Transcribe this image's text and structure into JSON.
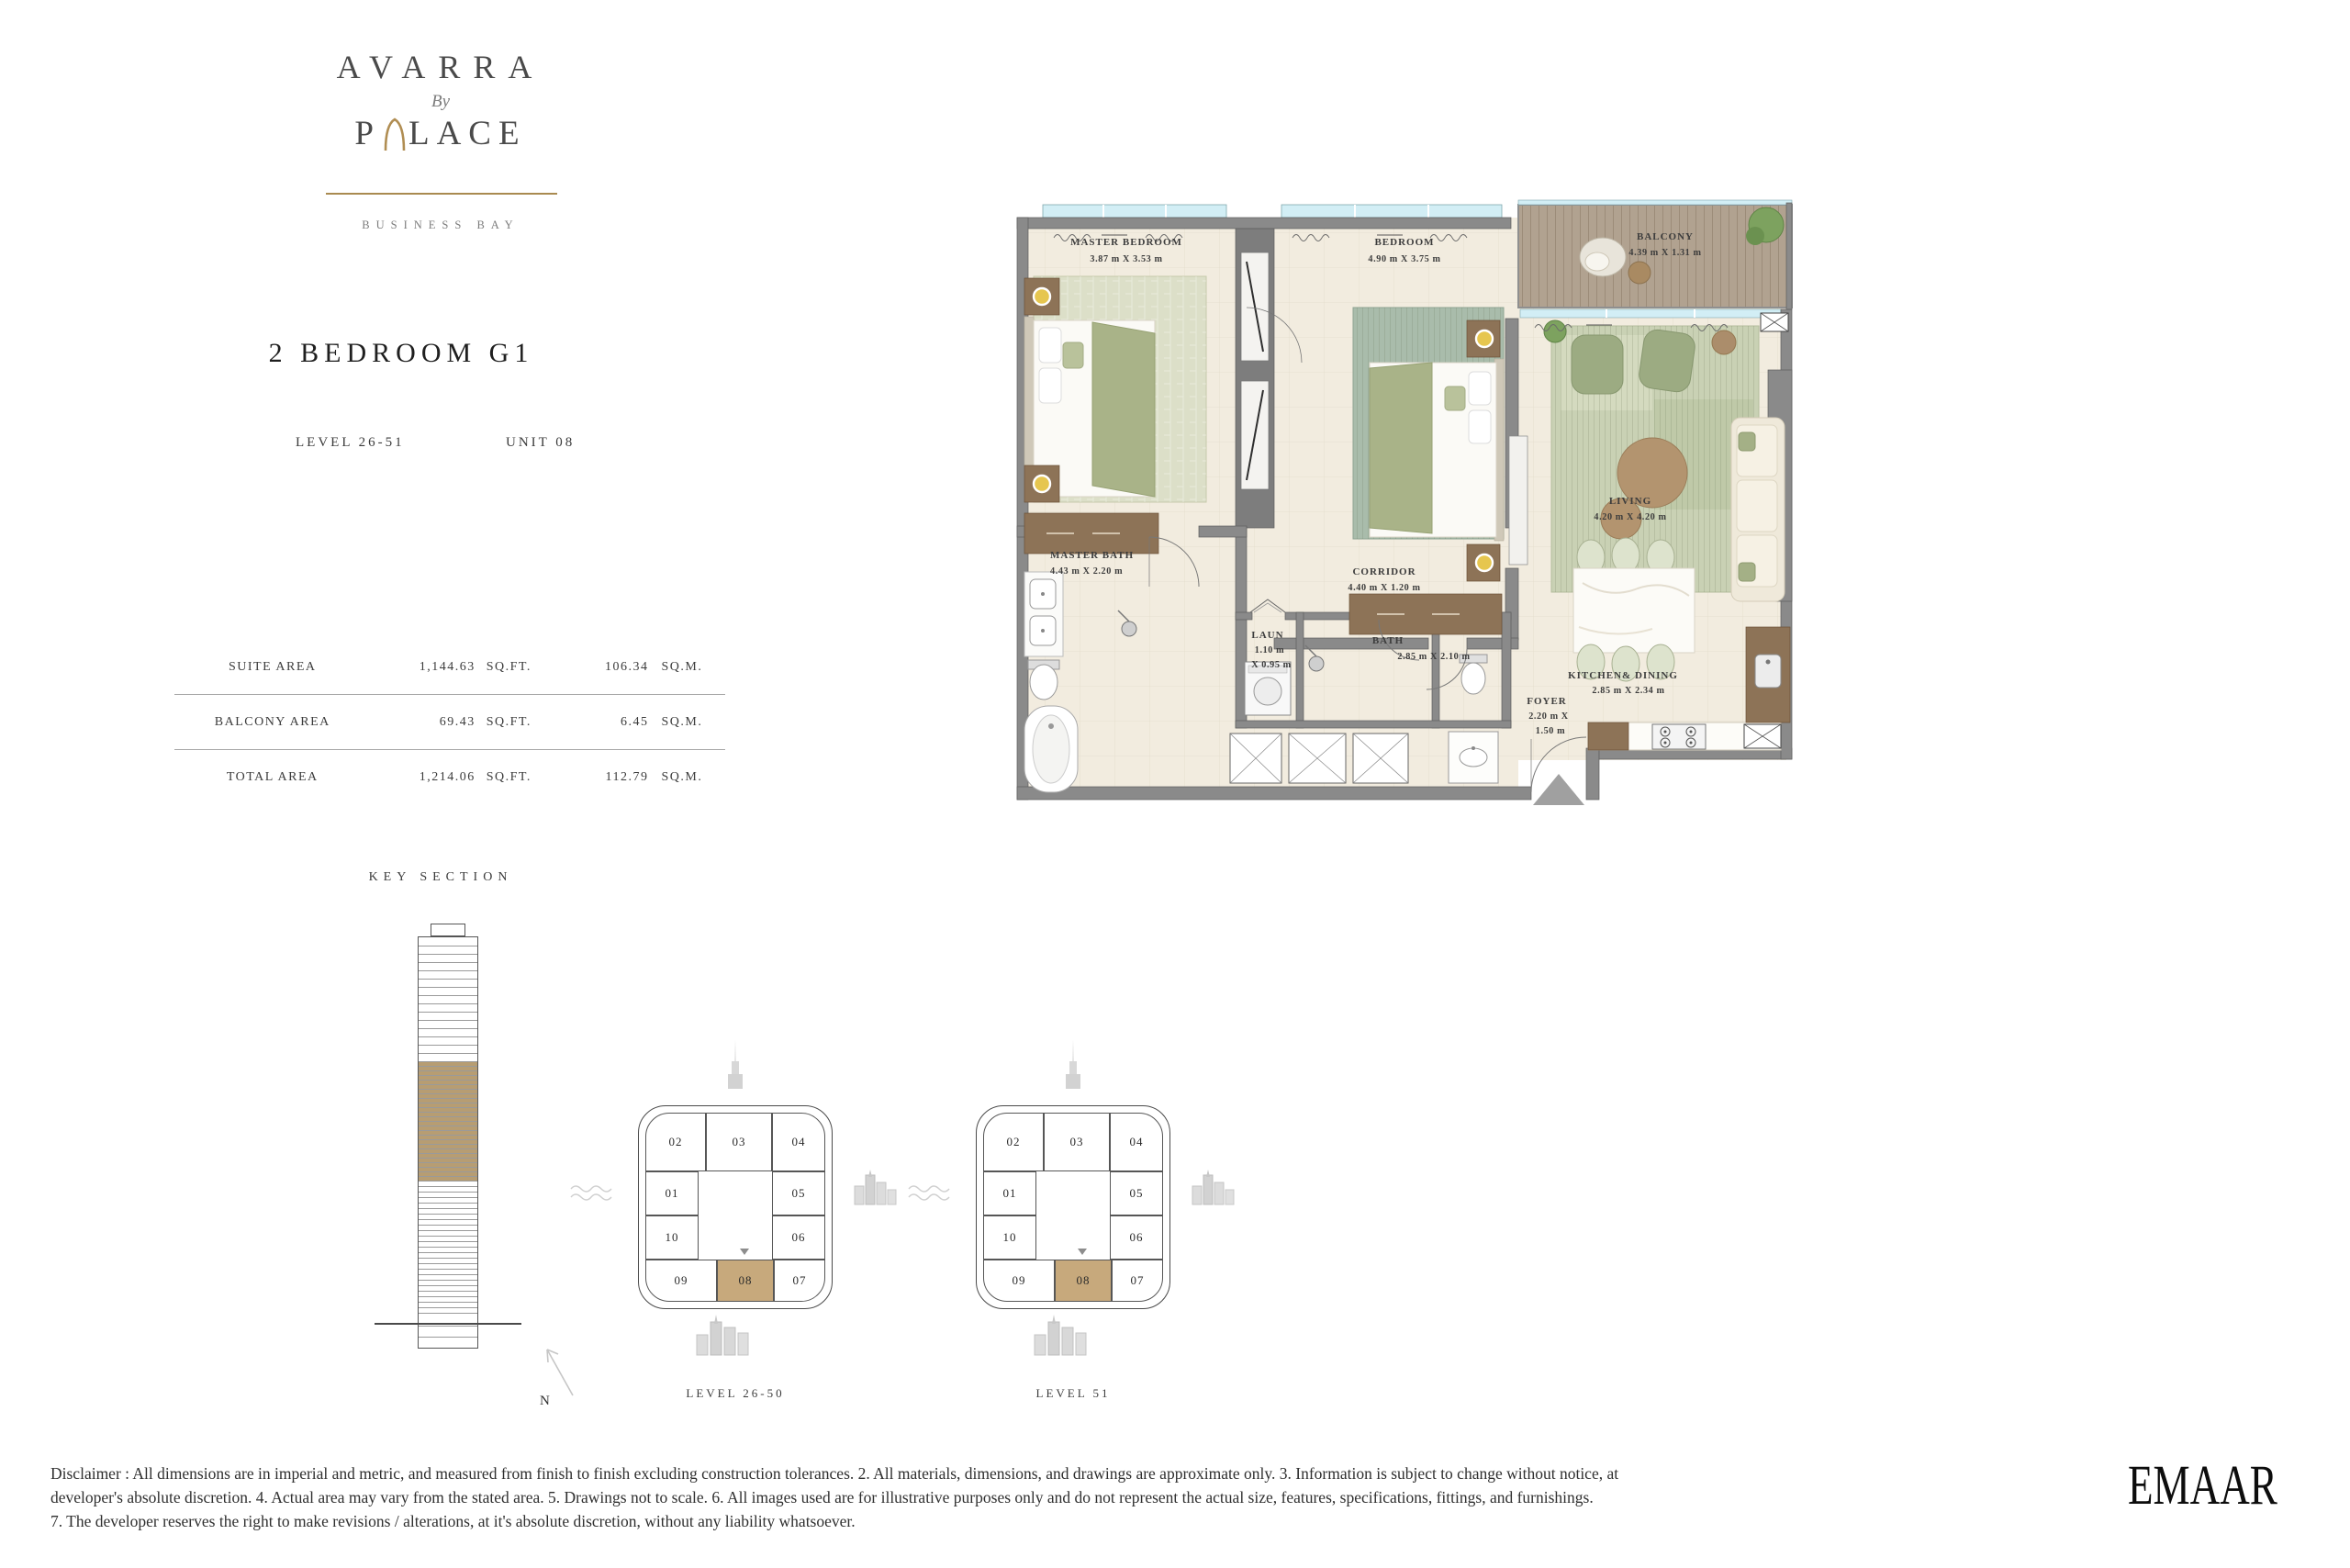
{
  "brand": {
    "name": "AVARRA",
    "by": "By",
    "palace_left": "P",
    "palace_right": "LACE",
    "tagline": "BUSINESS BAY",
    "gold_color": "#a98a50"
  },
  "unit_header": {
    "title": "2 BEDROOM G1",
    "level": "LEVEL 26-51",
    "unit": "UNIT 08"
  },
  "area_table": {
    "rows": [
      {
        "label": "SUITE AREA",
        "sqft": "1,144.63",
        "sqft_unit": "SQ.FT.",
        "sqm": "106.34",
        "sqm_unit": "SQ.M."
      },
      {
        "label": "BALCONY AREA",
        "sqft": "69.43",
        "sqft_unit": "SQ.FT.",
        "sqm": "6.45",
        "sqm_unit": "SQ.M."
      },
      {
        "label": "TOTAL AREA",
        "sqft": "1,214.06",
        "sqft_unit": "SQ.FT.",
        "sqm": "112.79",
        "sqm_unit": "SQ.M."
      }
    ]
  },
  "key_section": {
    "title": "KEY SECTION",
    "tower": {
      "floors_above_band": 15,
      "band_floors": 26,
      "floors_below_band": 14,
      "podium_floors": 10,
      "base_floors": 2,
      "band_color": "#b79d72"
    }
  },
  "key_plans": {
    "units": [
      "02",
      "03",
      "04",
      "01",
      "05",
      "10",
      "06",
      "09",
      "08",
      "07"
    ],
    "highlighted_unit": "08",
    "highlight_color": "#c7a97c",
    "plans": [
      {
        "label": "LEVEL 26-50"
      },
      {
        "label": "LEVEL 51"
      }
    ],
    "north_label": "N"
  },
  "floor_plan": {
    "rooms": {
      "master_bedroom": {
        "name": "MASTER BEDROOM",
        "dims": "3.87  m X  3.53  m"
      },
      "bedroom": {
        "name": "BEDROOM",
        "dims": "4.90  m X  3.75  m"
      },
      "balcony": {
        "name": "BALCONY",
        "dims": "4.39  m X  1.31  m"
      },
      "living": {
        "name": "LIVING",
        "dims": "4.20  m X  4.20  m"
      },
      "corridor": {
        "name": "CORRIDOR",
        "dims": "4.40  m X  1.20  m"
      },
      "master_bath": {
        "name": "MASTER BATH",
        "dims": "4.43  m X  2.20  m"
      },
      "laundry": {
        "name": "LAUN",
        "dims_line1": "1.10  m",
        "dims_line2": "X  0.95  m"
      },
      "bath": {
        "name": "BATH",
        "dims": "2.85  m X  2.10  m"
      },
      "kitchen_dining": {
        "name": "KITCHEN& DINING",
        "dims": "2.85  m X  2.34  m"
      },
      "foyer": {
        "name": "FOYER",
        "dims_line1": "2.20  m X",
        "dims_line2": "1.50  m"
      }
    }
  },
  "disclaimer": {
    "line1": "Disclaimer : All dimensions are in imperial and metric, and measured from finish to finish excluding construction tolerances. 2. All materials, dimensions, and drawings are approximate only. 3. Information is subject to change without notice, at",
    "line2": "developer's absolute discretion. 4. Actual area may vary from the stated area. 5. Drawings not to scale. 6. All images used are for illustrative purposes only and do not represent the actual size, features, specifications, fittings, and furnishings.",
    "line3": "7. The developer reserves the right to make revisions / alterations, at it's absolute discretion, without any liability whatsoever."
  },
  "developer_logo": "EMAAR"
}
